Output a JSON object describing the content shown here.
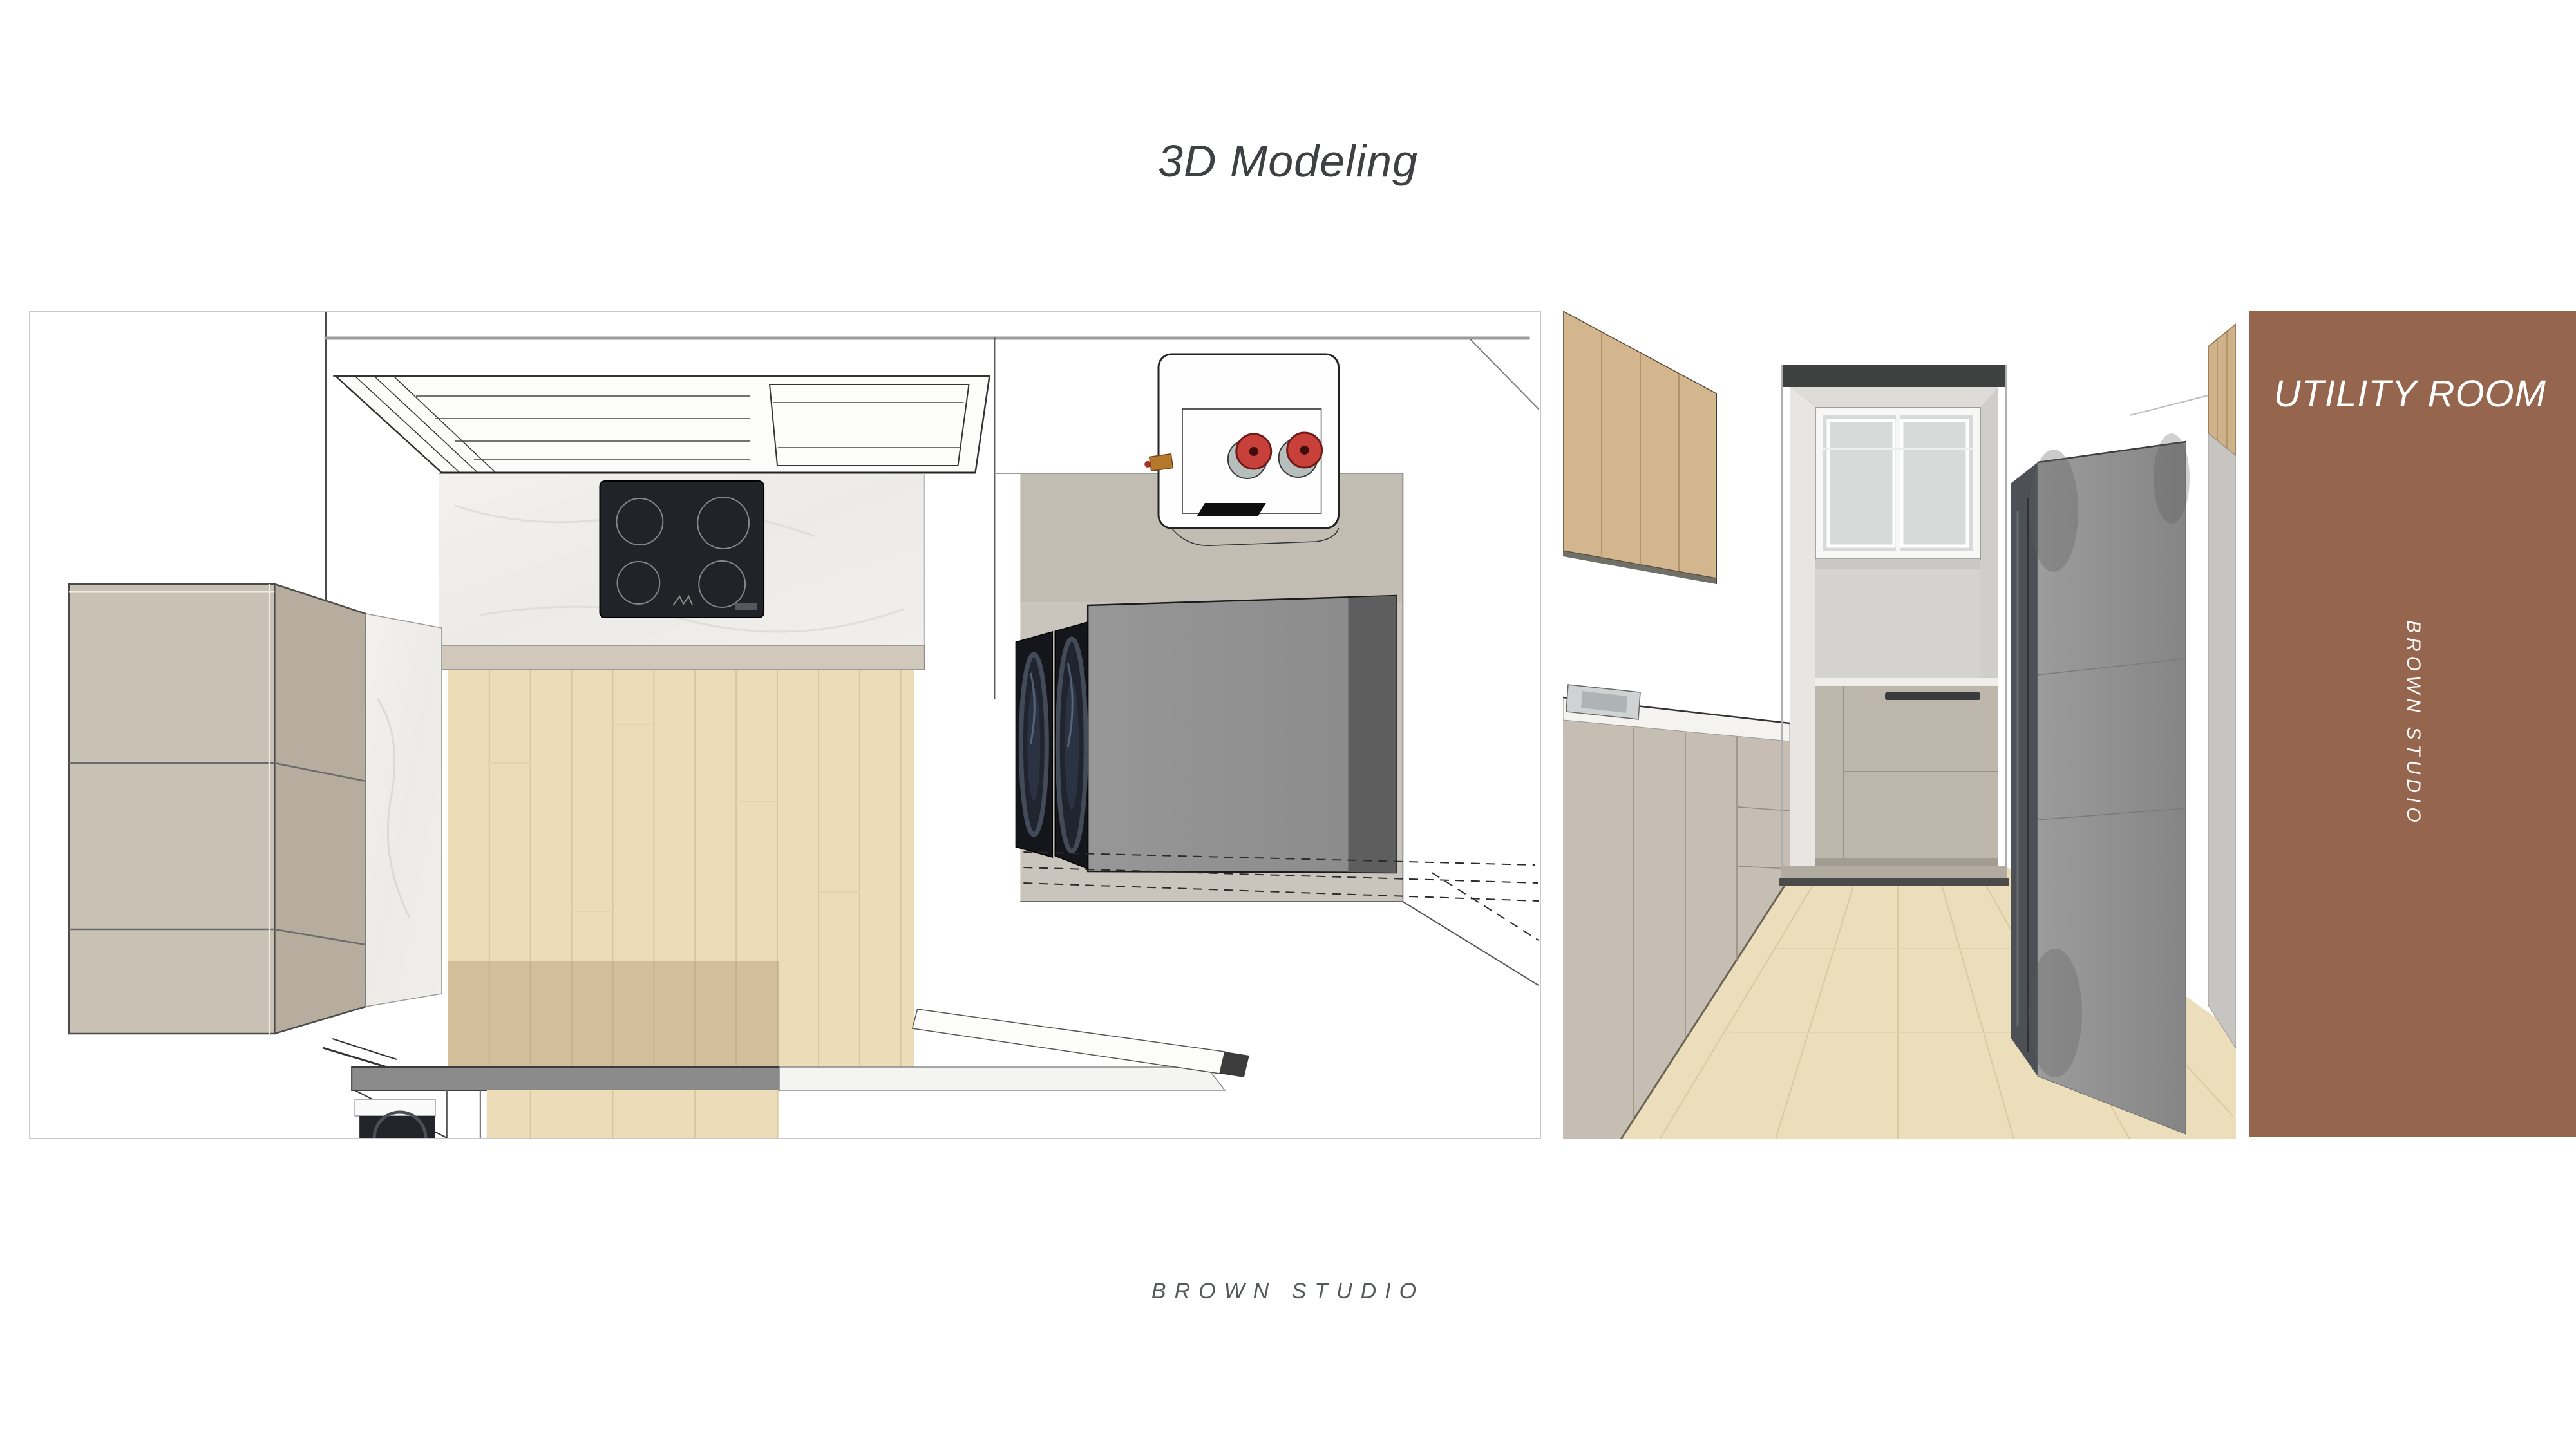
{
  "slide": {
    "title": "3D Modeling",
    "footer_studio_label": "BROWN STUDIO"
  },
  "sidebar": {
    "room_label": "UTILITY ROOM",
    "studio_label": "BROWN STUDIO"
  },
  "panels": {
    "plan": {
      "alt": "Top-down 3D plan render of kitchen and utility area with induction cooktop, range hood, tall cabinets, wood floor and stacked washer-dryer"
    },
    "perspective": {
      "alt": "Eye-level 3D render looking toward utility room doorway with wood upper cabinet, sink counter, window and tall gray storage unit"
    }
  },
  "colors": {
    "sidebar_brown": "#96654E",
    "title_gray": "#3f4043",
    "footer_gray": "#56595c",
    "panel_border": "#c9c9c9",
    "wood_floor": "#ecdcb8",
    "cabinet_taupe": "#c8c0b2",
    "cooktop_black": "#202327",
    "knob_red": "#c8403a",
    "washer_dark": "#15161b"
  }
}
